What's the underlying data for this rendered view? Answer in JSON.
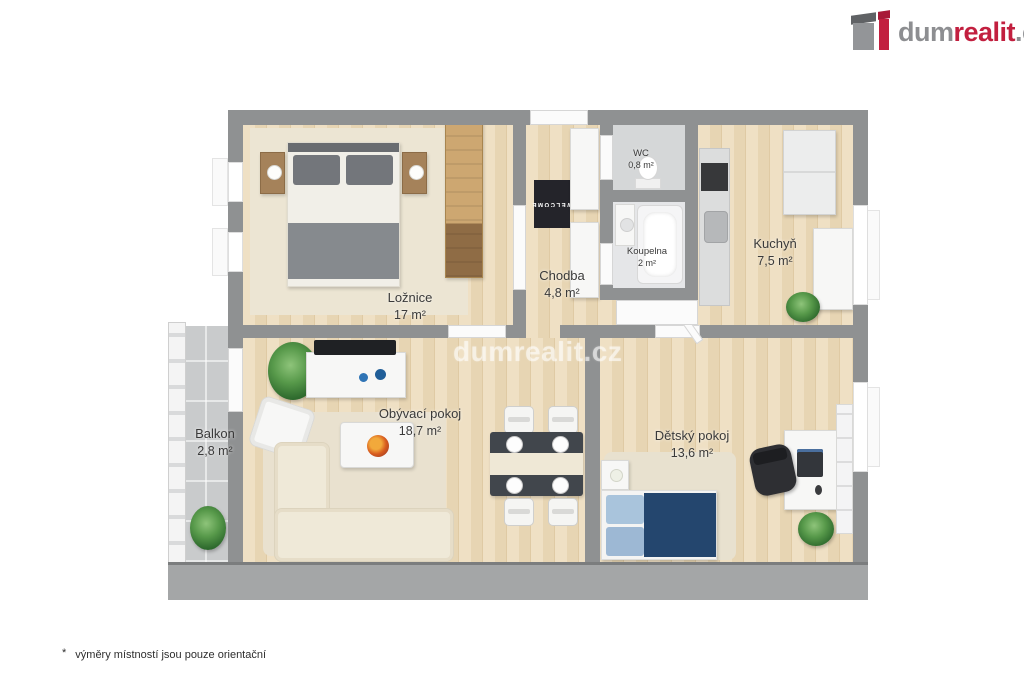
{
  "logo": {
    "brand_gray": "dum",
    "brand_red": "realit",
    "brand_suffix": ".cz",
    "brand_red_color": "#c21f3f",
    "brand_gray_color": "#8d8e91"
  },
  "watermark": {
    "text": "dumrealit.cz"
  },
  "floor_plan": {
    "rooms": {
      "loznice": {
        "name": "Ložnice",
        "area": "17 m²",
        "furniture": [
          "double-bed",
          "nightstand-left",
          "nightstand-right",
          "wardrobe",
          "carpet"
        ]
      },
      "chodba": {
        "name": "Chodba",
        "area": "4,8 m²",
        "furniture": [
          "welcome-doormat",
          "hall-cabinet",
          "hall-cabinet"
        ]
      },
      "wc": {
        "name": "WC",
        "area": "0,8 m²",
        "furniture": [
          "toilet"
        ]
      },
      "koupelna": {
        "name": "Koupelna",
        "area": "2 m²",
        "furniture": [
          "sink-vanity",
          "bathtub"
        ]
      },
      "kuchyn": {
        "name": "Kuchyň",
        "area": "7,5 m²",
        "furniture": [
          "kitchen-counter",
          "stove",
          "kitchen-sink",
          "fridge",
          "cabinet",
          "plant"
        ]
      },
      "obyvaci_pokoj": {
        "name": "Obývací pokoj",
        "area": "18,7 m²",
        "furniture": [
          "tv",
          "tv-stand",
          "palm-plant",
          "armchair",
          "rug",
          "sofa",
          "coffee-table",
          "fruit-bowl",
          "dining-table",
          "four-chairs"
        ]
      },
      "balkon": {
        "name": "Balkon",
        "area": "2,8 m²",
        "furniture": [
          "railing",
          "plant"
        ]
      },
      "detsky_pokoj": {
        "name": "Dětský pokoj",
        "area": "13,6 m²",
        "furniture": [
          "single-bed-blue",
          "nightstand",
          "rug",
          "desk",
          "laptop",
          "office-chair",
          "bookshelf",
          "plant"
        ]
      }
    },
    "doormat_text": "WELCOME"
  },
  "footnote": {
    "marker": "*",
    "text": "výměry místností jsou pouze orientační"
  },
  "colors": {
    "wall": "#8f9192",
    "wood_floor": "#e9d8b8",
    "carpet": "#ece5d3",
    "balcony_tile": "#c9cbcc",
    "bed_gray": "#85888c",
    "child_bed_navy": "#24466e",
    "brand_red": "#c21f3f"
  }
}
